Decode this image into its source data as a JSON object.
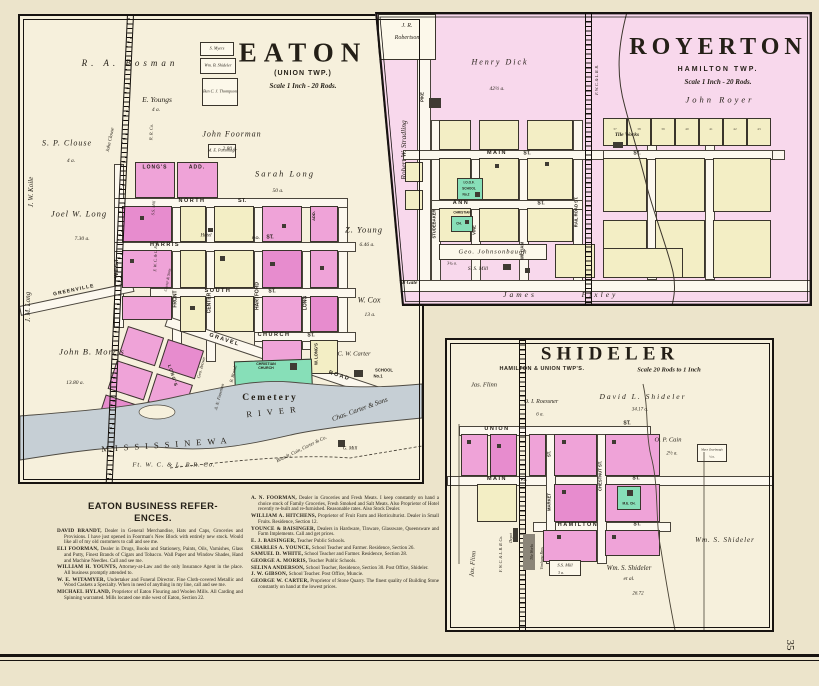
{
  "page": {
    "number": "35"
  },
  "eaton": {
    "title": "EATON",
    "township": "(UNION TWP.)",
    "scale": "Scale 1 Inch - 20 Rods.",
    "farms": {
      "bosman": "R. A. Bosman",
      "youngs": "E. Youngs",
      "youngs_acres": "4 a.",
      "foorman": "John Foorman",
      "foorman_acres": "2.80 a.",
      "clouse": "S. P. Clouse",
      "clouse_acres": "4 a.",
      "john_clouse": "John Clouse",
      "koile": "J. W. Koile",
      "joel_long": "Joel W. Long",
      "joel_long_acres": "7.30 a.",
      "jm_long": "J. M. Long",
      "morris": "John B. Morris",
      "morris_acres": "13.80 a.",
      "sarah_long": "Sarah Long",
      "sarah_long_acres": "50 a.",
      "z_young": "Z. Young",
      "z_young_acres": "6.46 a.",
      "cox": "W. Cox",
      "cox_acres": "13 a.",
      "cw_carter": "C. W. Carter",
      "chas_carter": "Chas. Carter & Sons",
      "myers": "S. Myers",
      "wb_shideler": "Wm. B. Shideler",
      "thompson": "Ben C. J. Thompson",
      "parsonage": "M. E. Parsonage",
      "b_brandt": "B. Brandt",
      "geo_brown": "Geo. Brown",
      "an_foorman": "A. N. Foorman",
      "brandt_cain": "Brandt, Cain, Carter & Co.",
      "g_mill": "G. Mill"
    },
    "streets": {
      "north": "NORTH",
      "harris": "HARRIS",
      "south": "SOUTH",
      "church": "CHURCH",
      "west": "WEST",
      "front": "FRONT",
      "center": "CENTER",
      "hartford": "HARTFORD",
      "long": "LONG",
      "gravel": "GRAVEL",
      "road": "ROAD",
      "greenville": "GREENVILLE",
      "st": "ST."
    },
    "features": {
      "cemetery": "Cemetery",
      "christian_church": "CHRISTIAN CHURCH",
      "school_a": "SCHOOL",
      "school_b": "No.1",
      "hotel": "Hotel",
      "po": "P.O.",
      "ss_mill": "S.S. Mill",
      "longs": "LONG'S",
      "add": "ADD.",
      "longs2": "LONG'S",
      "w_longs": "W. LONG'S",
      "river_name": "MISSISSINEWA",
      "river": "RIVER",
      "rr": "Ft. W. C. & L. R.R. Co.",
      "rr_vert": "F. W. C. & L. R. R.",
      "rr_co": "R. R. Co.",
      "carter_sons": "Carter & Sons"
    }
  },
  "royerton": {
    "title": "ROYERTON",
    "township": "HAMILTON TWP.",
    "scale": "Scale 1 Inch - 20 Rods.",
    "labels": {
      "robertson1": "J. R.",
      "robertson2": "Robertson",
      "dick": "Henry Dick",
      "dick_acres": "42½ a.",
      "royer": "John Royer",
      "stradling": "Robert W. Stradling",
      "pike": "PIKE",
      "studebaker": "STUDEBAKER",
      "vine": "VINE",
      "william": "WILLIAM",
      "railroad_st": "RAIL ROAD ST.",
      "main": "MAIN",
      "ann": "ANN",
      "st": "ST.",
      "johnsonbaugh": "Geo. Johnsonbaugh",
      "johnsonbaugh_acres": "3¾ a.",
      "ss_mill": "S. S. Mill",
      "toll_gate": "Toll Gate",
      "muncie": "Muncie & Eaton T. P. Co.",
      "james": "James",
      "pixley": "Pixley",
      "tile_works": "Tile Works",
      "ioof": "I.O.O.F.",
      "school": "SCHOOL",
      "school_no": "No.2",
      "christian": "CHRISTIAN",
      "ch": "CH.",
      "rr": "F. W. C. & L. R. R.",
      "lots": [
        "37",
        "38",
        "39",
        "40",
        "41",
        "42",
        "43"
      ]
    }
  },
  "shideler": {
    "title": "SHIDELER",
    "townships": "HAMILTON & UNION TWP'S.",
    "scale": "Scale 20 Rods to 1 Inch",
    "labels": {
      "flinn": "Jas. Flinn",
      "flinn2": "Jas. Flinn",
      "roessner": "O. I. Roessner",
      "roessner_acres": "6 a.",
      "david": "David L. Shideler",
      "david_acres": "34.17 a.",
      "cain": "O. P. Cain",
      "cain_acres": "2½ a.",
      "zearbaugh": "Mary Zearbaugh",
      "zearbaugh_acres": "¼ a.",
      "wm1": "Wm. S. Shideler",
      "wm2": "Wm. S. Shideler",
      "etal": "et al.",
      "acres2": "26.72",
      "union": "UNION",
      "main": "MAIN",
      "hamilton": "HAMILTON",
      "st": "ST.",
      "market": "MARKET",
      "chestnut": "CHESTNUT ST.",
      "po": "P.O.",
      "depot": "Depot",
      "rr": "F. W. C. & L. R. R. Co.",
      "tile_works": "Tile Works",
      "bros": "Vinshang Bros.",
      "ss_mill": "S.S. Mill",
      "ss_mill_acres": "3 a.",
      "me_ch": "M.E. CH."
    }
  },
  "business": {
    "heading1": "EATON BUSINESS REFER-",
    "heading2": "ENCES.",
    "left": [
      {
        "name": "DAVID BRANDT,",
        "text": "Dealer in General Merchandise, Hats and Caps, Groceries and Provisions. I have just opened in Foorman's New Block with entirely new stock. Would like all of my old customers to call and see me."
      },
      {
        "name": "ELI FOORMAN,",
        "text": "Dealer in Drugs, Books and Stationery, Paints, Oils, Varnishes, Glass and Putty, Finest Brands of Cigars and Tobacco. Wall Paper and Window Shades, Hand and Machine Needles. Call and see me."
      },
      {
        "name": "WILLIAM H. YOUNTS,",
        "text": "Attorney-at-Law and the only Insurance Agent in the place. All business promptly attended to."
      },
      {
        "name": "W. E. WITAMYER,",
        "text": "Undertaker and Funeral Director. Fine Cloth-covered Metallic and Wood Caskets a Specialty. When in need of anything in my line, call and see me."
      },
      {
        "name": "MICHAEL HYLAND,",
        "text": "Proprietor of Eaton Flouring and Woolen Mills. All Carding and Spinning warranted. Mills located one mile west of Eaton, Section 22."
      }
    ],
    "right": [
      {
        "name": "A. N. FOORMAN,",
        "text": "Dealer in Groceries and Fresh Meats. I keep constantly on hand a choice stock of Family Groceries, Fresh Smoked and Salt Meats. Also Proprietor of Hotel recently re-built and re-furnished. Reasonable rates. Also Stock Dealer."
      },
      {
        "name": "WILLIAM A. HITCHENS,",
        "text": "Proprietor of Fruit Farm and Horticulturist. Dealer in Small Fruits. Residence, Section 12."
      },
      {
        "name": "YOUNCE & BAISINGER,",
        "text": "Dealers in Hardware, Tinware, Glassware, Queensware and Farm Implements. Call and get prices."
      },
      {
        "name": "E. J. BAISINGER,",
        "text": "Teacher Public Schools."
      },
      {
        "name": "CHARLES A. YOUNCE,",
        "text": "School Teacher and Farmer. Residence, Section 26."
      },
      {
        "name": "SAMUEL D. WHITE,",
        "text": "School Teacher and Farmer. Residence, Section 28."
      },
      {
        "name": "GEORGE A. MORRIS,",
        "text": "Teacher Public Schools."
      },
      {
        "name": "SELINA ANDERSON,",
        "text": "School Teacher, Residence, Section 30. Post Office, Shideler."
      },
      {
        "name": "J. W. GIBSON,",
        "text": "School Teacher. Post Office, Muncie."
      },
      {
        "name": "GEORGE W. CARTER,",
        "text": "Proprietor of Stone Quarry. The finest quality of Building Stone constantly on hand at the lowest prices."
      }
    ]
  }
}
